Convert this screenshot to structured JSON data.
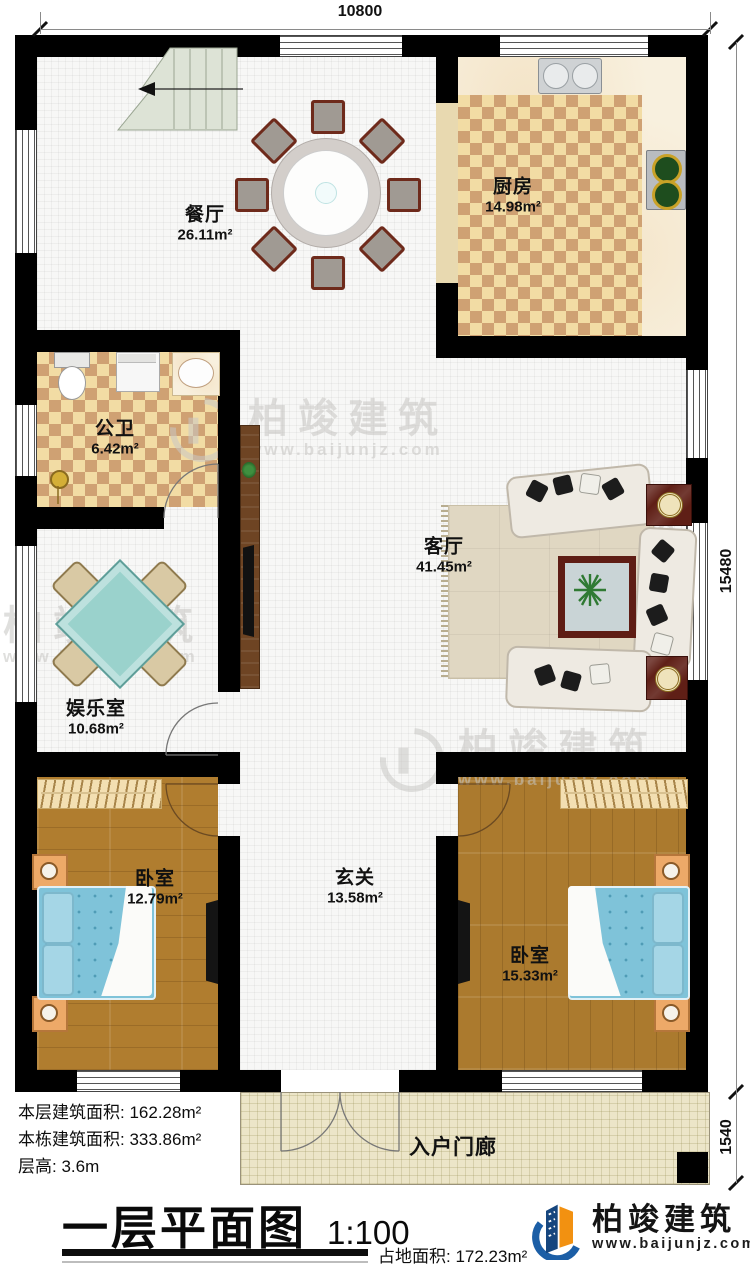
{
  "plan": {
    "rooms": {
      "dining": {
        "name": "餐厅",
        "area": "26.11m²"
      },
      "kitchen": {
        "name": "厨房",
        "area": "14.98m²"
      },
      "bathroom": {
        "name": "公卫",
        "area": "6.42m²"
      },
      "living": {
        "name": "客厅",
        "area": "41.45m²"
      },
      "entertainment": {
        "name": "娱乐室",
        "area": "10.68m²"
      },
      "bedroom_left": {
        "name": "卧室",
        "area": "12.79m²"
      },
      "foyer": {
        "name": "玄关",
        "area": "13.58m²"
      },
      "bedroom_right": {
        "name": "卧室",
        "area": "15.33m²"
      },
      "porch": {
        "name": "入户门廊"
      }
    },
    "dimensions": {
      "width_top": "10800",
      "height_right": "15480",
      "porch_height": "1540"
    }
  },
  "info": {
    "lines": [
      {
        "label": "本层建筑面积:",
        "value": "162.28m²"
      },
      {
        "label": "本栋建筑面积:",
        "value": "333.86m²"
      },
      {
        "label": "层高:",
        "value": "3.6m"
      }
    ],
    "site": {
      "label": "占地面积:",
      "value": "172.23m²"
    }
  },
  "title": {
    "text": "一层平面图",
    "scale": "1:100"
  },
  "brand": {
    "name": "柏竣建筑",
    "url": "www.baijunjz.com"
  },
  "watermark": {
    "name": "柏竣建筑",
    "url": "www.baijunjz.com"
  },
  "colors": {
    "wall": "#000000",
    "tile_dark": "#cfa173",
    "tile_light": "#f2dca4",
    "wood": "#b07d2f",
    "bed": "#7fc3d9",
    "brand_blue": "#1b5ea6",
    "brand_orange": "#f29111"
  }
}
